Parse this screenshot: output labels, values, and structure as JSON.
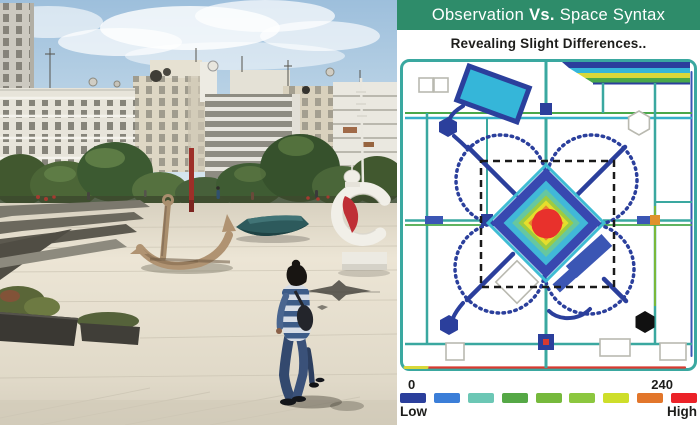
{
  "header": {
    "title_normal_left": "Observation",
    "title_bold": "Vs.",
    "title_normal_right": "Space Syntax",
    "subtitle": "Revealing Slight Differences.."
  },
  "legend": {
    "min": "0",
    "max": "240",
    "low": "Low",
    "high": "High",
    "colors": [
      "#2b3f9c",
      "#3b7ed8",
      "#6cc7b5",
      "#55a846",
      "#76b93c",
      "#8cc73f",
      "#cede2a",
      "#e2762b",
      "#eb2228"
    ]
  },
  "colors": {
    "header_bg": "#2e8c6a",
    "header_text": "#ffffff",
    "subtitle_text": "#1d1d1b"
  },
  "chart_data": {
    "type": "heatmap",
    "title": "Observation Vs. Space Syntax",
    "subtitle": "Revealing Slight Differences..",
    "colorbar": {
      "min": 0,
      "max": 240,
      "min_label": "Low",
      "max_label": "High",
      "colors": [
        "#2b3f9c",
        "#3b7ed8",
        "#6cc7b5",
        "#55a846",
        "#76b93c",
        "#8cc73f",
        "#cede2a",
        "#e2762b",
        "#eb2228"
      ]
    },
    "hotspots": [
      {
        "area": "central diamond plaza core",
        "value": "peak ~240 (red) fading orange-yellow-green-cyan to blue at edges"
      },
      {
        "area": "top boulevard band",
        "value": "graded blue/cyan/yellow/green wedge"
      },
      {
        "area": "grid paths, loops and borders",
        "value": "low-mid values (blue/teal/green traces)"
      }
    ],
    "annotations": [
      "dashed square observation zone",
      "four dotted circulation circles around core",
      "tilted rectangular elements",
      "hexagonal nodes (blue, black, outline)",
      "outlined squares and rectangles"
    ]
  },
  "photo": {
    "description": "Public plaza with large anchor sculpture, boat sculpture, white crescent monument, pedestrian walking, amphitheater steps, trees and white Mediterranean buildings under a blue sky"
  }
}
